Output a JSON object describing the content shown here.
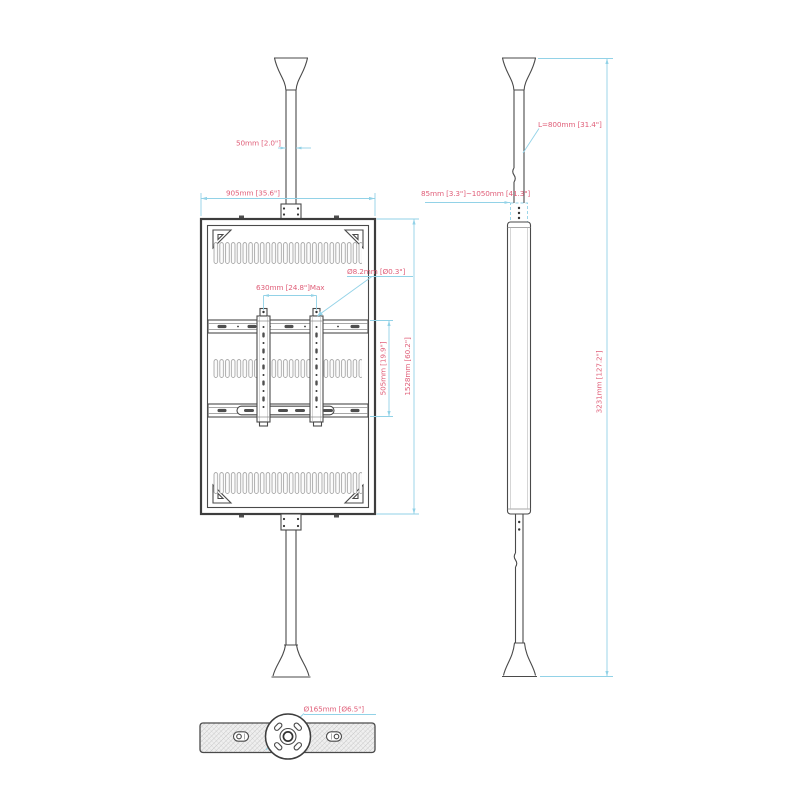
{
  "page": {
    "background": "#ffffff"
  },
  "drawing": {
    "colors": {
      "dimension_line": "#92d2e7",
      "dimension_text": "#e0607a",
      "drawing_line": "#4a4a4a"
    },
    "front_view": {
      "dim_pole_width": "50mm [2.0\"]",
      "dim_frame_width": "905mm [35.6\"]",
      "dim_bracket_span": "630mm [24.8\"]Max",
      "dim_hole_diameter": "Ø8.2mm [Ø0.3\"]",
      "dim_rail_height": "505mm [19.9\"]",
      "dim_frame_height": "1528mm [60.2\"]"
    },
    "side_view": {
      "dim_pole_length": "L=800mm [31.4\"]",
      "dim_adjustment_range": "85mm [3.3\"]~1050mm [41.3\"]",
      "dim_total_height": "3231mm [127.2\"]"
    },
    "bottom_view": {
      "dim_flange_diameter": "Ø165mm [Ø6.5\"]"
    }
  }
}
